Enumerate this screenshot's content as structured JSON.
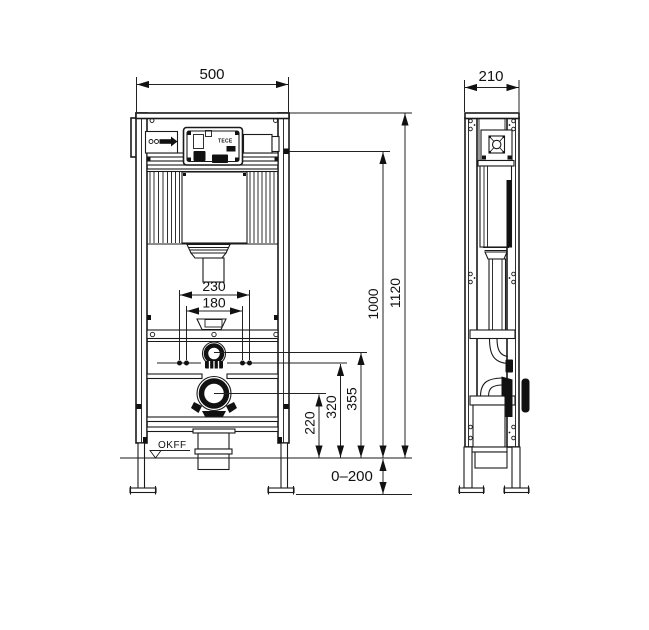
{
  "drawing": {
    "labels": {
      "floor_reference": "OKFF",
      "brand": "TECE"
    },
    "dimensions_mm": {
      "front": {
        "width": "500",
        "overall_height": "1120",
        "upper_height": "1000",
        "stud_spacing_outer": "230",
        "stud_spacing_inner": "180",
        "flush_pipe_center_height": "355",
        "stud_height": "320",
        "drain_center_height": "220",
        "foot_adjust_range": "0–200"
      },
      "side": {
        "depth": "210"
      }
    }
  }
}
